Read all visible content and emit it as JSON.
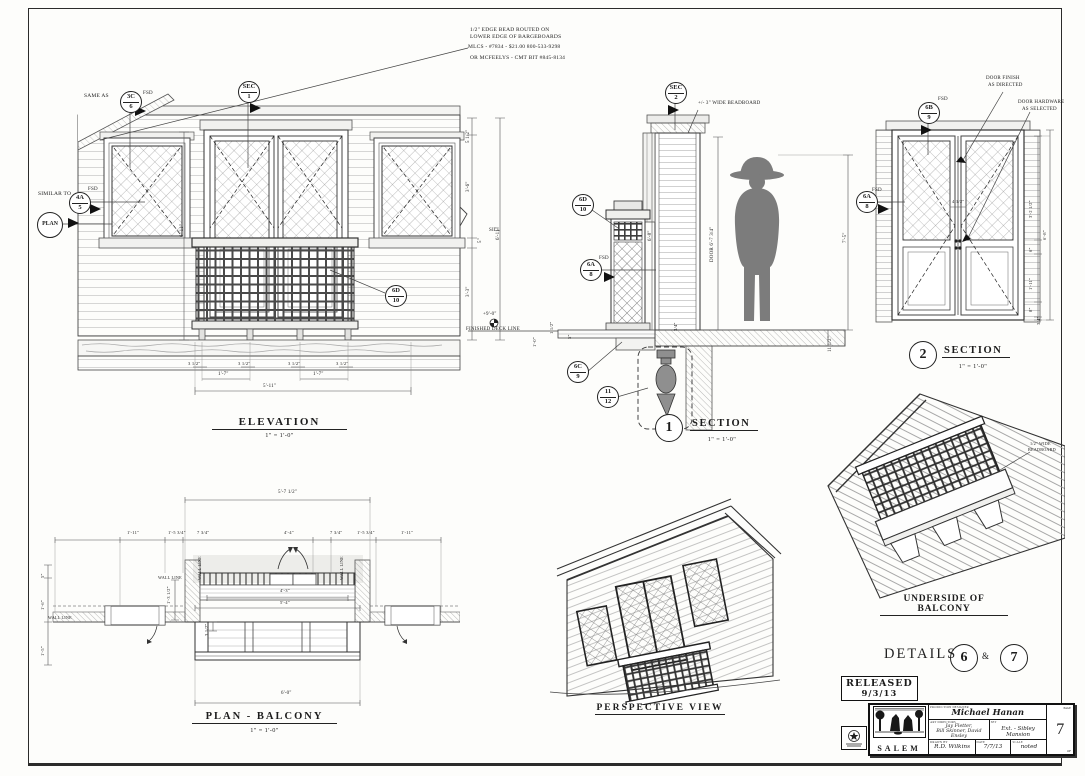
{
  "notes": {
    "routed1": "1/2\" EDGE BEAD ROUTED ON",
    "routed2": "LOWER EDGE OF BARGEBOARDS",
    "routed3": "MLCS - #7834 - $21.00  800-533-9298",
    "routed4": "OR MCFEELYS - CMT BIT #845-8134"
  },
  "bubbles": {
    "same_as": "SAME AS",
    "similar_to": "SIMILAR TO",
    "fsd": "FSD",
    "plan": "PLAN",
    "b3c": [
      "3C",
      "6"
    ],
    "bsec1": [
      "SEC",
      "1"
    ],
    "b4a": [
      "4A",
      "5"
    ],
    "b6d": [
      "6D",
      "10"
    ],
    "bsec2": [
      "SEC",
      "2"
    ],
    "b6a": [
      "6A",
      "8"
    ],
    "b6c": [
      "6C",
      "9"
    ],
    "b11": [
      "11",
      "12"
    ],
    "b6b": [
      "6B",
      "9"
    ]
  },
  "deck": {
    "label": "FINISHED DECK LINE",
    "elev": "+9'-0\""
  },
  "elevation": {
    "title": "ELEVATION",
    "scale": "1\" = 1'-0\"",
    "dim_512": "5 1/2\"",
    "dim_36": "3'-6\"",
    "sill": "SILL",
    "dim_5": "5\"",
    "dim_33": "3'-3\"",
    "dim_611": "6'-11\"",
    "dim_312": "3 1/2\"",
    "dim_17": "1'-7\"",
    "dim_511": "5'-11\""
  },
  "section1": {
    "num": "1",
    "title": "SECTION",
    "scale": "1\" = 1'-0\"",
    "beadboard": "+/- 3\" WIDE BEADBOARD",
    "dim_68": "6'-8\"",
    "door_dim": "DOOR   6'-7 3/4\"",
    "dim_75": "7'-5\"",
    "dim_1112": "11 1/2\"",
    "dim_112": "1 1/2\"",
    "dim_5": "5\"",
    "dim_10": "1'-0\"",
    "dim_34": "3/4\""
  },
  "section2": {
    "num": "2",
    "title": "SECTION",
    "scale": "1\" = 1'-0\"",
    "finish1": "DOOR FINISH",
    "finish2": "AS DIRECTED",
    "hardware1": "DOOR HARDWARE",
    "hardware2": "AS SELECTED",
    "dim_412": "4 1/2\"",
    "dim_3212": "3'-2 1/2\"",
    "dim_6": "6\"",
    "dim_111": "1'-11\"",
    "dim_8": "8\"",
    "dim_34": "3/4\"",
    "dim_68": "6'-8\""
  },
  "plan": {
    "title": "PLAN -  BALCONY",
    "scale": "1\" = 1'-0\"",
    "dim_5712": "5'-7 1/2\"",
    "dim_111": "1'-11\"",
    "dim_1534": "1'-5 3/4\"",
    "dim_734": "7 3/4\"",
    "dim_44": "4'-4\"",
    "dim_43": "4'-3\"",
    "dim_54": "5'-4\"",
    "dim_5": "5\"",
    "dim_16": "1'-6\"",
    "dim_15": "1'-5\"",
    "dim_1312": "1'-3 1/2\"",
    "dim_312": "3 1/2\"",
    "dim_60": "6'-0\"",
    "wall_line": "WALL LINE"
  },
  "perspective": {
    "title": "PERSPECTIVE  VIEW"
  },
  "underside": {
    "title": "UNDERSIDE OF BALCONY",
    "note1": "1/2\" WIDE",
    "note2": "BEADBOARD"
  },
  "details": {
    "label": "DETAILS",
    "d6": "6",
    "amp": "&",
    "d7": "7"
  },
  "released": {
    "l1": "RELEASED",
    "l2": "9/3/13"
  },
  "titleblock": {
    "show": "SALEM",
    "designer_label": "PRODUCTION DESIGNER",
    "designer": "Michael Hanan",
    "art_label": "ART DIRECTORS",
    "art_line1": "Jay Fletter,",
    "art_line2": "Bill Skinner, David Ensley",
    "set_label": "SET",
    "set_name": "Ext. - Sibley Mansion",
    "drawn_label": "DRAWN BY",
    "drawn": "R.D. Wilkins",
    "date_label": "DATE",
    "date": "7/7/13",
    "scale_label": "SCALE",
    "scale": "noted",
    "page_label": "PAGE",
    "page": "7",
    "of_label": "OF"
  }
}
